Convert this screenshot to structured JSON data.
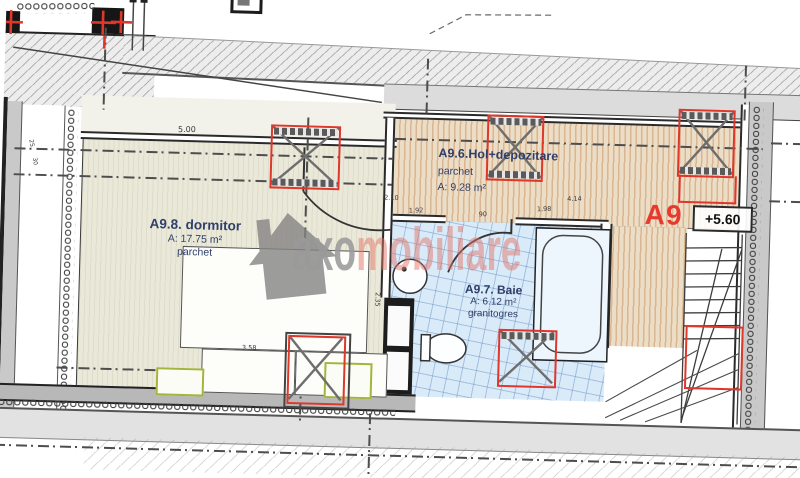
{
  "apartment": {
    "code": "A9",
    "elevation": "+5.60"
  },
  "rooms": {
    "bedroom": {
      "name": "A9.8. dormitor",
      "area": "A: 17.75 m²",
      "finish": "parchet"
    },
    "hall": {
      "name": "A9.6.Hol+depozitare",
      "finish": "parchet",
      "area": "A: 9.28 m²"
    },
    "bathroom": {
      "name": "A9.7. Baie",
      "area": "A: 6.12 m²",
      "finish": "granitogres"
    }
  },
  "dimensions": {
    "bedroom_top_width": "5.00",
    "hall_left": "2.10",
    "hall_width_1": "1.92",
    "door_width": "90",
    "hall_width_2": "1.98",
    "hall_width_3": "4.14",
    "bedroom_bottom": "3.58",
    "bedroom_right": "2.35",
    "wall_left_1": "25",
    "wall_left_2": "30"
  },
  "watermark": {
    "prefix": "axo",
    "suffix": "mobiliare"
  },
  "colors": {
    "bedroom_fill": "#eae8d9",
    "hall_fill": "#ecddc6",
    "bath_fill": "#d9eaf8",
    "wall_gray": "#c9c9c9",
    "marker_red": "#df372c",
    "label_navy": "#2f3f69",
    "watermark_gray": "#9a9a9a",
    "watermark_red": "#e2766b"
  }
}
